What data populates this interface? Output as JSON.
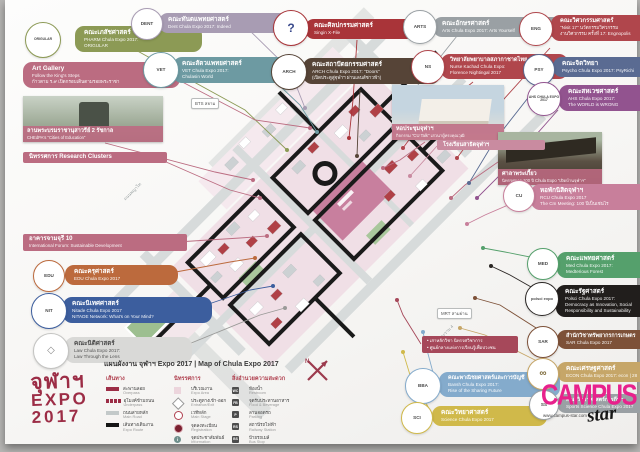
{
  "colors": {
    "accent_red": "#9c2d46",
    "legend_heading": "#b0404f",
    "campus_star_magenta": "#e8218c",
    "expo_area_pink": "#f0dfe6",
    "expo_route_black": "#1a1a1a"
  },
  "legend": {
    "title": "แผนผังงาน จุฬาฯ Expo 2017 | Map of Chula Expo 2017",
    "routes": {
      "heading": "เส้นทาง",
      "items": [
        {
          "th": "สะพานลอย",
          "en": "Overpass"
        },
        {
          "th": "อุโมงค์ข้ามถนน",
          "en": "Underpass"
        },
        {
          "th": "ถนนสายหลัก",
          "en": "Main Road"
        },
        {
          "th": "เส้นทางเดินงาน",
          "en": "Expo Route"
        }
      ]
    },
    "expo": {
      "heading": "นิทรรศการ",
      "items": [
        {
          "th": "บริเวณงาน",
          "en": "Expo Area"
        },
        {
          "th": "ประตูทางเข้า-ออก",
          "en": "Entrance/Exit"
        },
        {
          "th": "เวทีหลัก",
          "en": "Main Stage"
        },
        {
          "th": "จุดลงทะเบียน",
          "en": "Registration"
        },
        {
          "th": "จุดประชาสัมพันธ์",
          "en": "Information"
        }
      ]
    },
    "facilities": {
      "heading": "สิ่งอำนวยความสะดวก",
      "items": [
        {
          "th": "ห้องน้ำ",
          "en": "Restroom"
        },
        {
          "th": "จุดรับประทานอาหาร",
          "en": "Food & Beverage"
        },
        {
          "th": "ลานจอดรถ",
          "en": "Parking"
        },
        {
          "th": "สถานีรถไฟฟ้า",
          "en": "Railway Station"
        },
        {
          "th": "ป้ายรถเมล์",
          "en": "Bus Stop"
        }
      ]
    }
  },
  "compass_label": "N",
  "expo_logo": {
    "line1": "จุฬาฯ",
    "line2": "EXPO",
    "line3": "2017"
  },
  "campus_star": {
    "word": "CAMPUS",
    "script": "star",
    "url": "www.campus-star.com"
  },
  "map_labels": {
    "bts": "BTS สยาม",
    "mrt": "MRT สามย่าน",
    "road1": "ถนนพญาไท",
    "road2": "ถนนอังรีดูนังต์",
    "road3": "ถนนพระราม 4"
  },
  "photos": {
    "statue": {
      "title": "ลานพระบรมราชานุสาวรีย์ 2 รัชกาล",
      "sub": "CHEdPA's \"Cities of Education\""
    },
    "auditorium": {
      "title": "หอประชุมจุฬาฯ",
      "sub": "กิจกรรม \"CU Talk\" เสวนาผู้ทรงคุณวุฒิ"
    },
    "sala": {
      "title": "ศาลาพระเกี้ยว",
      "sub": "นิทรรศการ 100 ปี Chula Expo \"เปิดบ้านจุฬาฯ\""
    }
  },
  "bars": {
    "research": {
      "title": "นิทรรศการ Research Clusters"
    },
    "chamchuri": {
      "title": "อาคารจามจุรี 10",
      "sub": "International Forum: Sustainable Development"
    },
    "satit": {
      "title": "โรงเรียนสาธิตจุฬาฯ"
    }
  },
  "info_box": {
    "line1": "• เสาหลักวิชา นิทรรศวิชาการ",
    "line2": "• ศูนย์กลางแห่งการเรียนรู้เพื่อปวงชน"
  },
  "callouts": {
    "pharm": {
      "badge": "ORIGULAR",
      "title": "คณะเภสัชศาสตร์",
      "sub1": "PHARM Chula Expo 2017:",
      "sub2": "ORIGULAR"
    },
    "artgallery": {
      "title": "Art Gallery",
      "sub1": "Follow the King's Steps",
      "sub2": "ก้าวตาม ร.๙ เปิดกรอบเดินตามรอยพระราชา"
    },
    "dent": {
      "badge": "DENT",
      "title": "คณะทันตแพทยศาสตร์",
      "sub1": "Dent Chula Expo 2017: Indeed"
    },
    "vet": {
      "badge": "VET",
      "title": "คณะสัตวแพทยศาสตร์",
      "sub1": "VET Chula Expo 2017:",
      "sub2": "Chulasin World"
    },
    "finearts": {
      "badge": "?",
      "title": "คณะศิลปกรรมศาสตร์",
      "sub1": "Singin X-File"
    },
    "arch": {
      "badge": "ARCH",
      "title": "คณะสถาปัตยกรรมศาสตร์",
      "sub1": "ARCH Chula Expo 2017: \"Doors\"",
      "sub2": "(เปิดประตูสู่จุฬาฯ ผ่านเลนส์ชาวฟ้า)"
    },
    "arts": {
      "badge": "ARTS",
      "title": "คณะอักษรศาสตร์",
      "sub1": "Arts Chula Expo 2017: Arts Yourself"
    },
    "nurse": {
      "badge": "NS",
      "title": "วิทยาลัยพยาบาลสภากาชาดไทย",
      "sub1": "Nurse Kachad Chula Expo:",
      "sub2": "Florence Nightingal 2017"
    },
    "eng": {
      "badge": "ENG",
      "title": "คณะวิศวกรรมศาสตร์",
      "sub1": "\"Nisit 17\" นวัตกรรมวิศวกรรม",
      "sub2": "งานวิศวกรรม ครั้งที่ 17: Engnopolis"
    },
    "psych": {
      "badge": "PSY",
      "title": "คณะจิตวิทยา",
      "sub1": "Psycho Chula Expo 2017: PsyRichi"
    },
    "ahs": {
      "badge": "AHS CHULA EXPO 2017",
      "title": "คณะสหเวชศาสตร์",
      "sub1": "AHS Chula Expo 2017:",
      "sub2": "The WORLD is WRONG"
    },
    "edu": {
      "badge": "EDU",
      "title": "คณะครุศาสตร์",
      "sub1": "EDU Chula Expo 2017"
    },
    "nitade": {
      "badge": "NIT",
      "title": "คณะนิเทศศาสตร์",
      "sub1": "Nitade Chula Expo 2017",
      "sub2": "NITADE Network: What's on Your Mind?"
    },
    "law": {
      "badge": "◇",
      "title": "คณะนิติศาสตร์",
      "sub1": "Law Chula Expo 2017:",
      "sub2": "Law Through the Lens"
    },
    "rcu": {
      "badge": "CU",
      "title": "หอพักนิสิตจุฬาฯ",
      "sub1": "RCU Chula Expo 2017",
      "sub2": "The Cm Meeting: 100 ปีเป็นเช่นไร"
    },
    "med": {
      "badge": "MED",
      "title": "คณะแพทยศาสตร์",
      "sub1": "Med Chula Expo 2017:",
      "sub2": "Medterious Forest"
    },
    "polsci": {
      "badge": "polsci expo",
      "title": "คณะรัฐศาสตร์",
      "sub1": "Polsci Chula Expo 2017:",
      "sub2": "Democracy as Innovation, Social",
      "sub3": "Responsibility and Sustainability"
    },
    "sar": {
      "badge": "SAR",
      "title": "สำนักวิชาทรัพยากรการเกษตร",
      "sub1": "SAR Chula Expo 2017"
    },
    "econ": {
      "badge": "∞",
      "title": "คณะเศรษฐศาสตร์",
      "sub1": "ECON Chula Expo 2017: econ | 28"
    },
    "commerce": {
      "badge": "BBA",
      "title": "คณะพาณิชยศาสตร์และการบัญชี",
      "sub1": "Bansh Chula Expo 2017:",
      "sub2": "Rise of the Sharing Future"
    },
    "science": {
      "badge": "SCI",
      "title": "คณะวิทยาศาสตร์",
      "sub1": "Science Chula Expo 2017"
    },
    "sportssci": {
      "badge": "SS",
      "title": "คณะวิทยาศาสตร์การกีฬา",
      "sub1": "Sports Science Chula Expo 2017"
    }
  }
}
